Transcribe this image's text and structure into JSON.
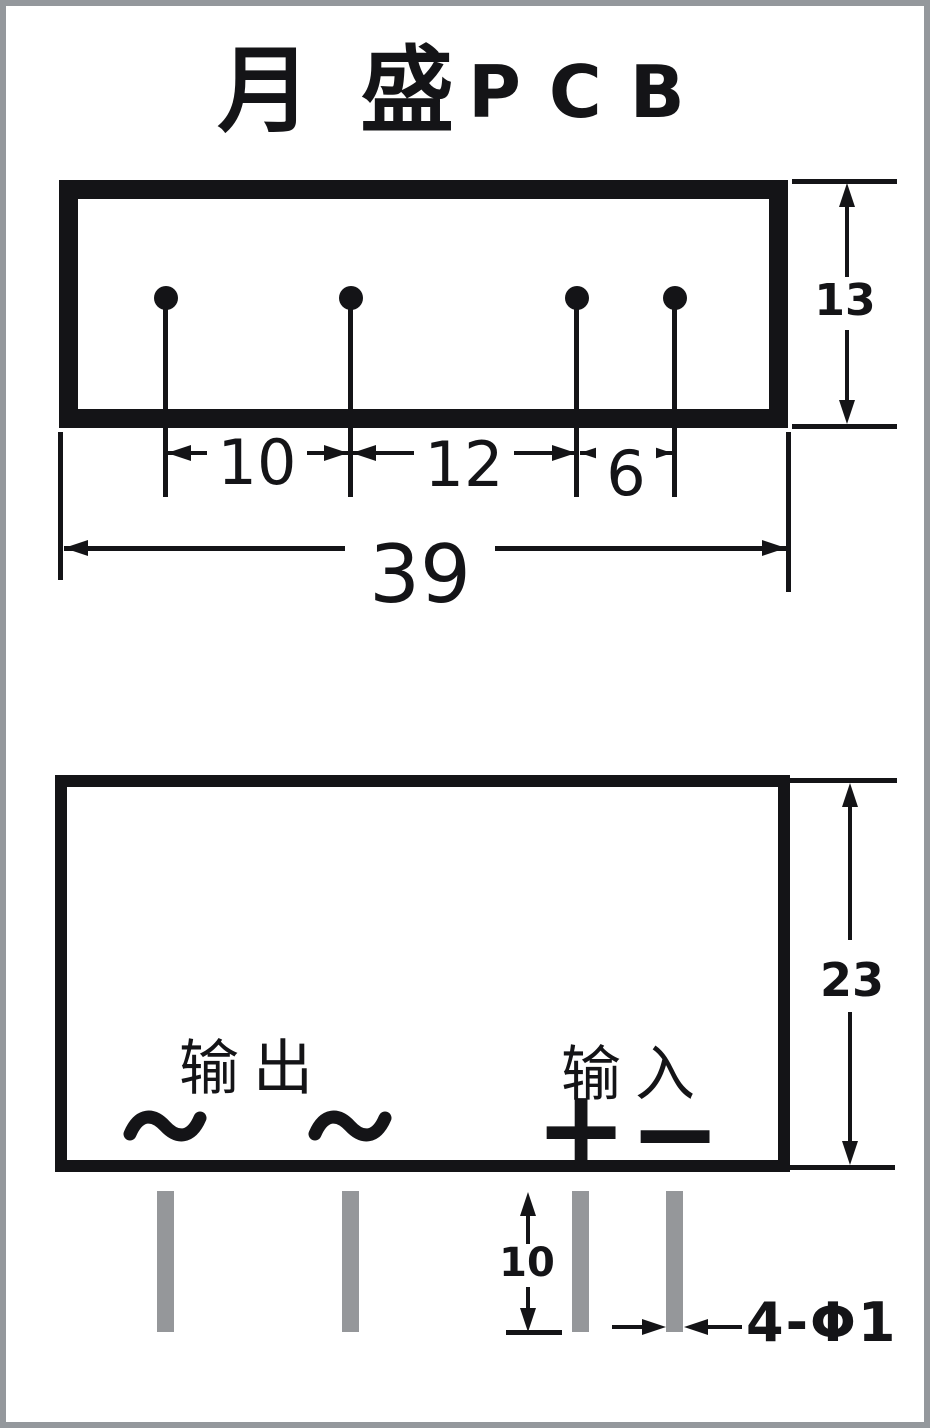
{
  "page": {
    "background": "#ffffff",
    "frame_color": "#94989c",
    "ink_color": "#141417",
    "pin_color": "#95979a"
  },
  "title": {
    "cjk": "月 盛",
    "latin": "PCB"
  },
  "views": {
    "top": {
      "height_dim": "13",
      "pitch_dims": [
        "10",
        "12",
        "6"
      ],
      "overall_width_dim": "39"
    },
    "front": {
      "height_dim": "23",
      "output_label": "输出",
      "input_label": "输入",
      "ac_symbols": [
        "~",
        "~"
      ],
      "plus_symbol": "+",
      "minus_symbol": "−",
      "pin_length_dim": "10",
      "pin_diameter_spec": "4-Φ1"
    }
  }
}
